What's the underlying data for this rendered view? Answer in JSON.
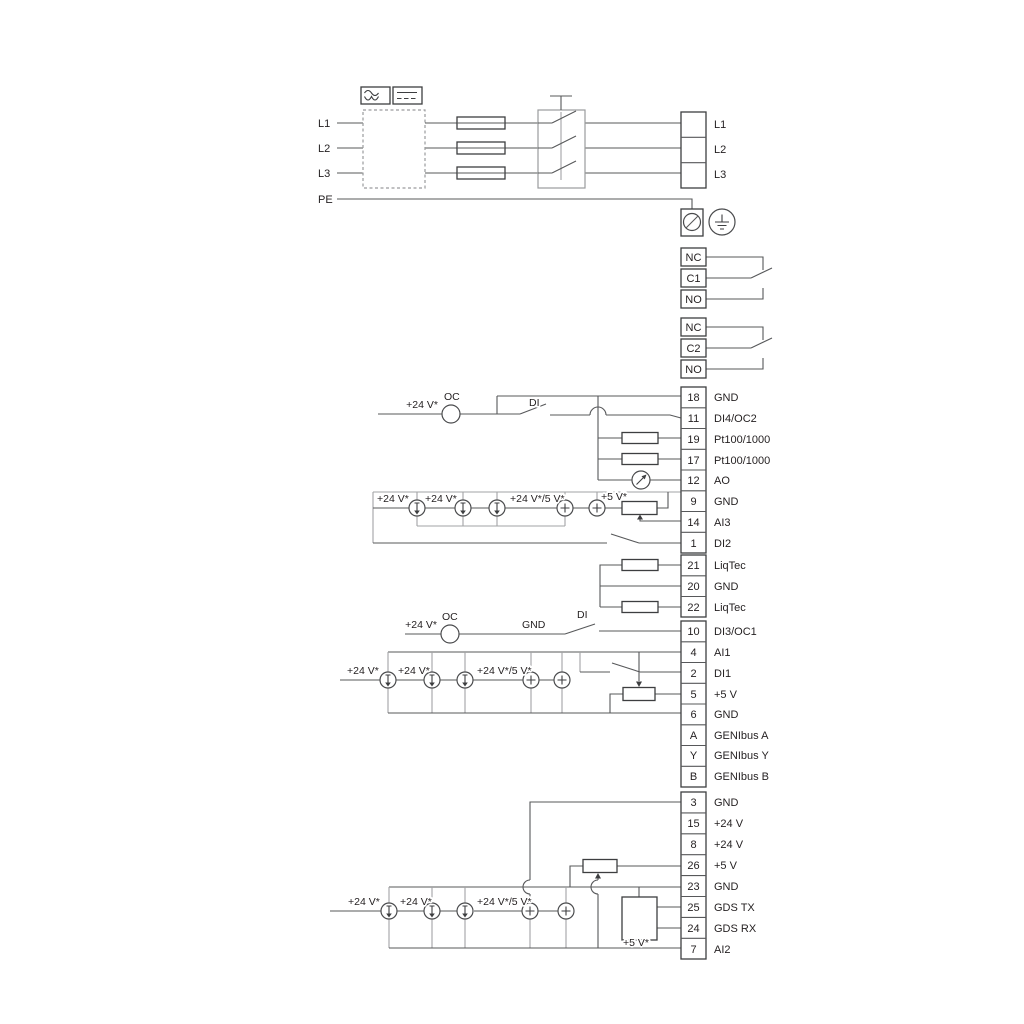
{
  "power_in": {
    "l1": "L1",
    "l2": "L2",
    "l3": "L3",
    "pe": "PE"
  },
  "power_out": {
    "l1": "L1",
    "l2": "L2",
    "l3": "L3"
  },
  "relay1": {
    "cells": [
      "NC",
      "C1",
      "NO"
    ]
  },
  "relay2": {
    "cells": [
      "NC",
      "C2",
      "NO"
    ]
  },
  "io1": {
    "rows": [
      {
        "num": "18",
        "label": "GND"
      },
      {
        "num": "11",
        "label": "DI4/OC2"
      },
      {
        "num": "19",
        "label": "Pt100/1000"
      },
      {
        "num": "17",
        "label": "Pt100/1000"
      },
      {
        "num": "12",
        "label": "AO"
      },
      {
        "num": "9",
        "label": "GND"
      },
      {
        "num": "14",
        "label": "AI3"
      },
      {
        "num": "1",
        "label": "DI2"
      }
    ]
  },
  "liqtec": {
    "rows": [
      {
        "num": "21",
        "label": "LiqTec"
      },
      {
        "num": "20",
        "label": "GND"
      },
      {
        "num": "22",
        "label": "LiqTec"
      }
    ]
  },
  "io2": {
    "rows": [
      {
        "num": "10",
        "label": "DI3/OC1"
      },
      {
        "num": "4",
        "label": "AI1"
      },
      {
        "num": "2",
        "label": "DI1"
      },
      {
        "num": "5",
        "label": "+5 V"
      },
      {
        "num": "6",
        "label": "GND"
      },
      {
        "num": "A",
        "label": "GENIbus A"
      },
      {
        "num": "Y",
        "label": "GENIbus Y"
      },
      {
        "num": "B",
        "label": "GENIbus B"
      }
    ]
  },
  "io3": {
    "rows": [
      {
        "num": "3",
        "label": "GND"
      },
      {
        "num": "15",
        "label": "+24 V"
      },
      {
        "num": "8",
        "label": "+24 V"
      },
      {
        "num": "26",
        "label": "+5 V"
      },
      {
        "num": "23",
        "label": "GND"
      },
      {
        "num": "25",
        "label": "GDS TX"
      },
      {
        "num": "24",
        "label": "GDS RX"
      },
      {
        "num": "7",
        "label": "AI2"
      }
    ]
  },
  "ann": {
    "v24": "+24 V*",
    "v24v5": "+24 V*/5 V*",
    "v5": "+5 V*",
    "oc": "OC",
    "di": "DI",
    "gnd": "GND"
  },
  "colors": {
    "wire": "#57585a",
    "bus": "#a2a3a5",
    "ink": "#231f20"
  }
}
